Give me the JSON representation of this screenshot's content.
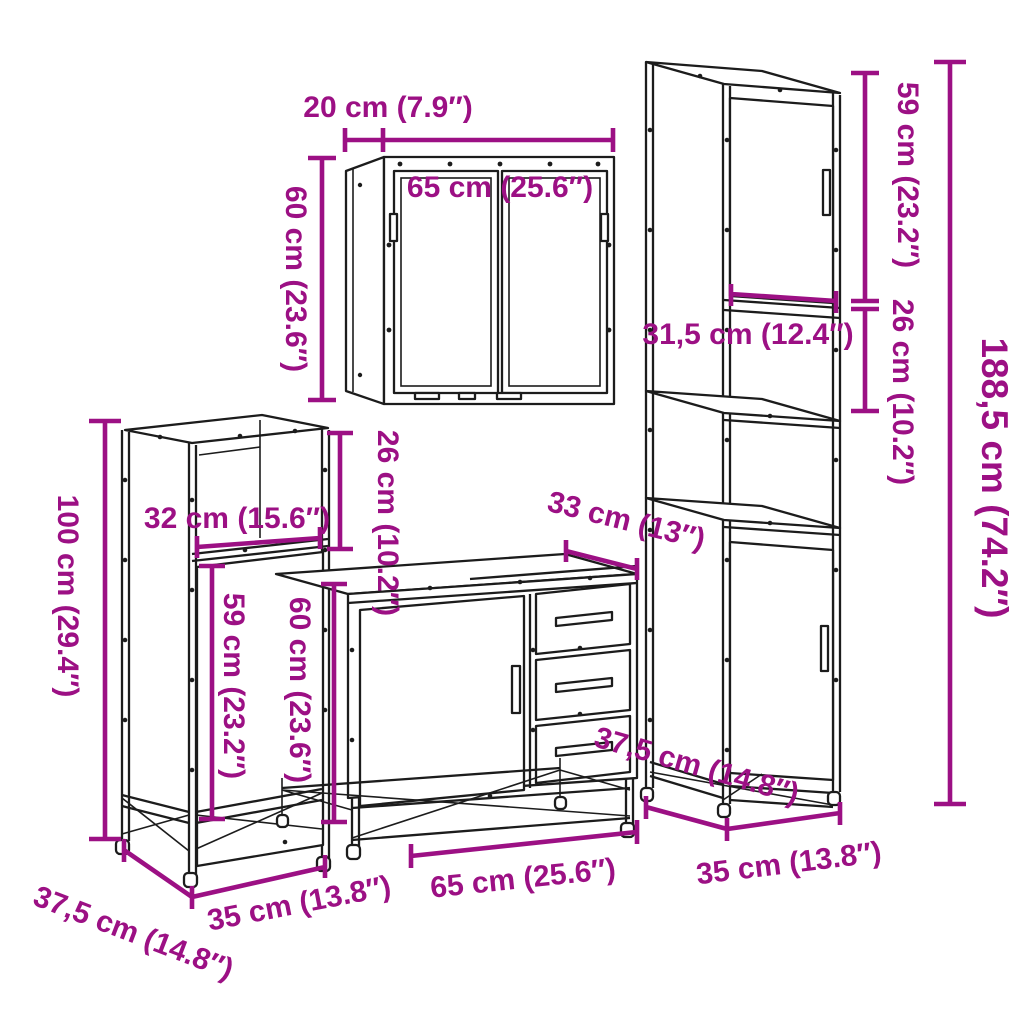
{
  "diagram": {
    "type": "furniture-dimension-diagram",
    "description": "4-piece bathroom furniture set line drawing with dimension callouts",
    "units": [
      "cm",
      "in"
    ],
    "colors": {
      "dimension": "#9c1084",
      "line_art": "#1c1c1c",
      "background": "#ffffff"
    },
    "labels": {
      "mirror_depth": "20 cm (7.9″)",
      "mirror_width": "65 cm (25.6″)",
      "mirror_height": "60 cm (23.6″)",
      "mirror_gap": "26 cm (10.2″)",
      "tall_top_door_height": "59 cm (23.2″)",
      "tall_shelf_gap": "26 cm (10.2″)",
      "tall_total_height": "188,5 cm (74.2″)",
      "tall_inner_width": "31,5 cm (12.4″)",
      "tall_width": "35 cm (13.8″)",
      "tall_depth": "37,5 cm (14.8″)",
      "side_inner_width": "32 cm (15.6″)",
      "side_height": "100 cm (29.4″)",
      "side_door_height": "59 cm (23.2″)",
      "side_width": "35 cm (13.8″)",
      "side_depth": "37,5 cm (14.8″)",
      "vanity_depth": "33 cm (13″)",
      "vanity_height": "60 cm (23.6″)",
      "vanity_width": "65 cm (25.6″)"
    }
  }
}
